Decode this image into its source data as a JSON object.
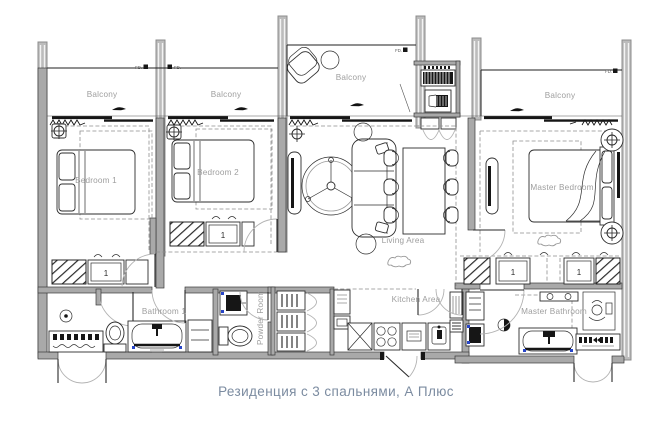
{
  "plan": {
    "caption": "Резиденция с 3 спальнями, А Плюс",
    "rooms": {
      "balcony1": "Balcony",
      "balcony2": "Balcony",
      "balcony3": "Balcony",
      "balcony4": "Balcony",
      "bedroom1": "Bedroom 1",
      "bedroom2": "Bedroom 2",
      "master_bedroom": "Master Bedroom",
      "living": "Living Area",
      "kitchen": "Kitchen Area",
      "bathroom1": "Bathroom 1",
      "powder": "Powder Room",
      "master_bathroom": "Master Bathroom"
    },
    "markers": {
      "fd1": "FD.",
      "fd2": "FD.",
      "fd3": "FD.",
      "fd4": "FD.",
      "closet1": "1",
      "closet2": "1",
      "closet3": "1",
      "closet4": "1"
    },
    "colors": {
      "label": "#9e9e9e",
      "caption": "#7b8ba0",
      "wall": "#a9a9a9",
      "line": "#1f1f1f",
      "accent_blue": "#2745c8"
    }
  }
}
